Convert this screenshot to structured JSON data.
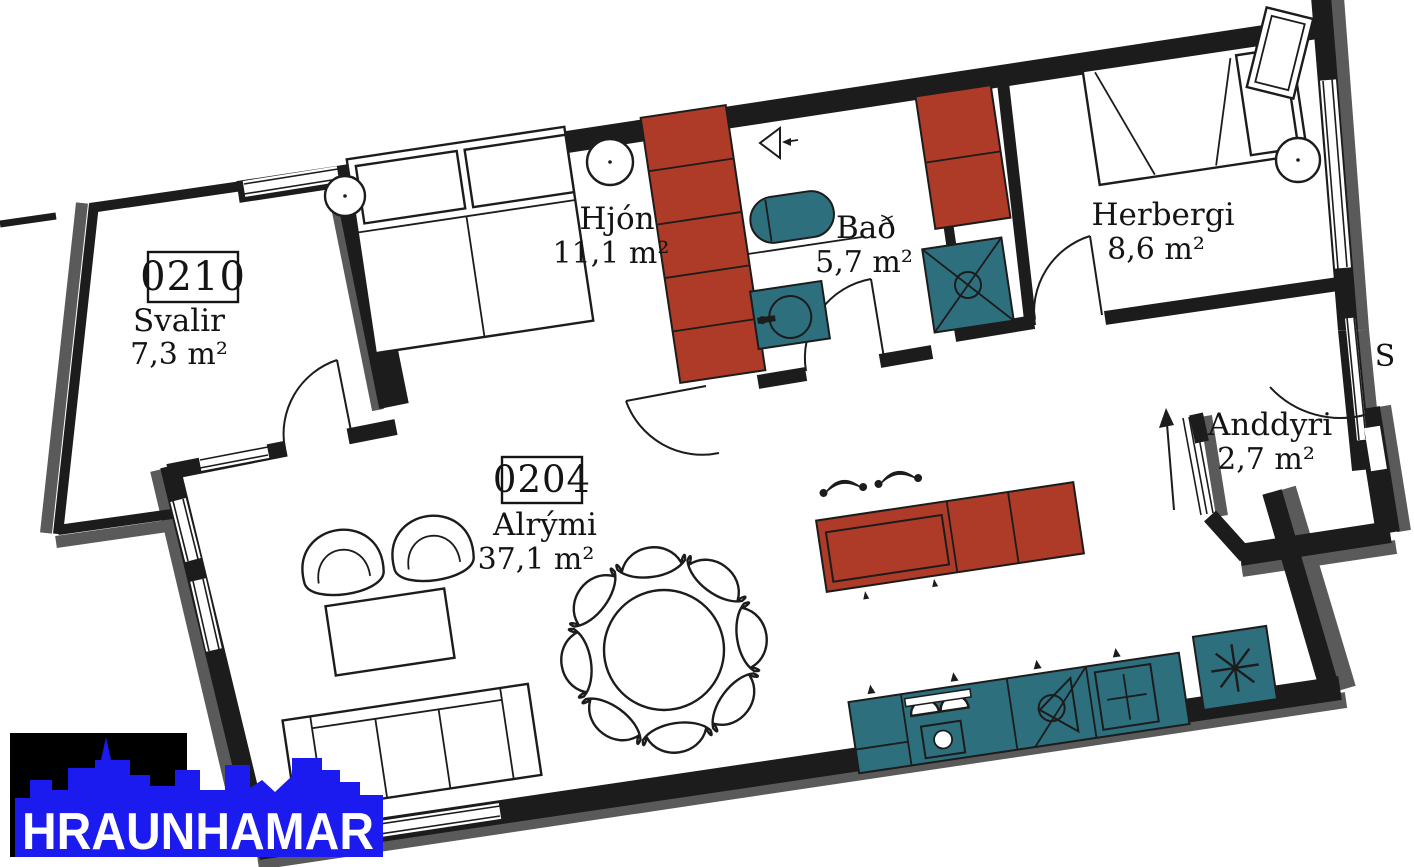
{
  "plan": {
    "title": "Apartment floor plan",
    "compass": "S",
    "balcony_unit_number": "0210",
    "unit_number": "0204",
    "rooms": [
      {
        "name": "Svalir",
        "area": "7,3 m²"
      },
      {
        "name": "Hjón",
        "area": "11,1 m²"
      },
      {
        "name": "Bað",
        "area": "5,7 m²"
      },
      {
        "name": "Herbergi",
        "area": "8,6 m²"
      },
      {
        "name": "Alrými",
        "area": "37,1 m²"
      },
      {
        "name": "Anddyri",
        "area": "2,7 m²"
      }
    ],
    "colors": {
      "wall_black": "#1c1c1c",
      "wall_shadow_gray": "#5a5a5a",
      "cabinet_red": "#ae3a28",
      "fixture_teal": "#2e6f7e",
      "logo_blue": "#1b1bf0"
    }
  },
  "logo": {
    "brand": "HRAUNHAMAR"
  }
}
